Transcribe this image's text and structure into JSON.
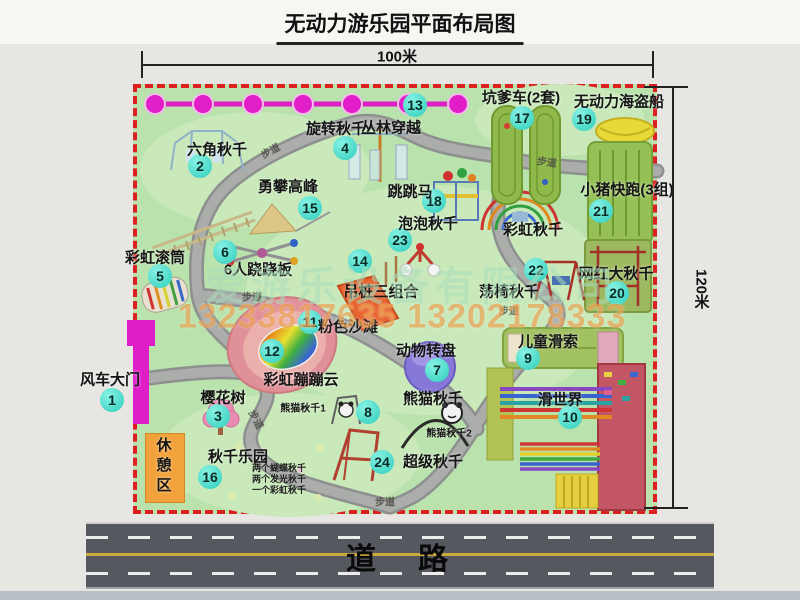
{
  "title": "无动力游乐园平面布局图",
  "dimensions": {
    "top": "100米",
    "right": "120米"
  },
  "road_label": "道　路",
  "watermark": {
    "company": "爱游乐设备有限公司",
    "phone": "13233817635 13202178333"
  },
  "colors": {
    "park_green": "#b9e2ac",
    "border_red": "#dc1f1f",
    "badge_teal": "#2fcdbb",
    "road_gray": "#56585f",
    "zipline_magenta": "#e01ec8",
    "rest_orange": "#f2a23a",
    "center_line_yellow": "#c9a93c"
  },
  "park": {
    "items": [
      {
        "id": "windmill-gate",
        "num": "1",
        "label": "风车大门",
        "bx": 112,
        "by": 400,
        "lx": 110,
        "ly": 379
      },
      {
        "id": "hex-swing",
        "num": "2",
        "label": "六角秋千",
        "bx": 200,
        "by": 166,
        "lx": 217,
        "ly": 149
      },
      {
        "id": "sakura-tree",
        "num": "3",
        "label": "樱花树",
        "bx": 218,
        "by": 416,
        "lx": 223,
        "ly": 397
      },
      {
        "id": "rotating-swing",
        "num": "4",
        "label": "旋转秋千",
        "bx": 345,
        "by": 148,
        "lx": 336,
        "ly": 128
      },
      {
        "id": "rainbow-roller",
        "num": "5",
        "label": "彩虹滚筒",
        "bx": 160,
        "by": 276,
        "lx": 155,
        "ly": 257
      },
      {
        "id": "seesaw-6p",
        "num": "6",
        "label": "6人跷跷板",
        "bx": 225,
        "by": 252,
        "lx": 258,
        "ly": 269
      },
      {
        "id": "animal-turntable",
        "num": "7",
        "label": "动物转盘",
        "bx": 437,
        "by": 370,
        "lx": 426,
        "ly": 350
      },
      {
        "id": "panda-swing",
        "num": "8",
        "label": "熊猫秋千",
        "bx": 368,
        "by": 412,
        "lx": 433,
        "ly": 398
      },
      {
        "id": "kids-zipline",
        "num": "9",
        "label": "儿童滑索",
        "bx": 528,
        "by": 358,
        "lx": 548,
        "ly": 341
      },
      {
        "id": "slide-world",
        "num": "10",
        "label": "滑世界",
        "bx": 570,
        "by": 417,
        "lx": 560,
        "ly": 399
      },
      {
        "id": "pink-beach",
        "num": "11",
        "label": "粉色沙滩",
        "bx": 310,
        "by": 322,
        "lx": 348,
        "ly": 326
      },
      {
        "id": "rainbow-cloud",
        "num": "12",
        "label": "彩虹蹦蹦云",
        "bx": 272,
        "by": 351,
        "lx": 301,
        "ly": 379
      },
      {
        "id": "jungle-crossing",
        "num": "13",
        "label": "丛林穿越",
        "bx": 415,
        "by": 105,
        "lx": 391,
        "ly": 127
      },
      {
        "id": "pile-combo",
        "num": "14",
        "label": "吊桩三组合",
        "bx": 360,
        "by": 261,
        "lx": 381,
        "ly": 291
      },
      {
        "id": "brave-peak",
        "num": "15",
        "label": "勇攀高峰",
        "bx": 310,
        "by": 208,
        "lx": 288,
        "ly": 186
      },
      {
        "id": "swing-park",
        "num": "16",
        "label": "秋千乐园",
        "bx": 210,
        "by": 477,
        "lx": 238,
        "ly": 456,
        "sub": [
          "两个蝴蝶秋千",
          "两个发光秋千",
          "一个彩虹秋千"
        ],
        "sx": 252,
        "sy": 463
      },
      {
        "id": "pit-car",
        "num": "17",
        "label": "坑爹车(2套)",
        "bx": 522,
        "by": 118,
        "lx": 521,
        "ly": 97
      },
      {
        "id": "jump-horse",
        "num": "18",
        "label": "跳跳马",
        "bx": 434,
        "by": 201,
        "lx": 410,
        "ly": 191
      },
      {
        "id": "pirate-ship",
        "num": "19",
        "label": "无动力海盗船",
        "bx": 584,
        "by": 119,
        "lx": 619,
        "ly": 101
      },
      {
        "id": "big-net-swing",
        "num": "20",
        "label": "网红大秋千",
        "bx": 617,
        "by": 293,
        "lx": 616,
        "ly": 273
      },
      {
        "id": "pig-run",
        "num": "21",
        "label": "小猪快跑(3组)",
        "bx": 601,
        "by": 211,
        "lx": 627,
        "ly": 189
      },
      {
        "id": "chair-swing",
        "num": "22",
        "label": "荡椅秋千",
        "bx": 536,
        "by": 270,
        "lx": 509,
        "ly": 291
      },
      {
        "id": "bubble-swing",
        "num": "23",
        "label": "泡泡秋千",
        "bx": 400,
        "by": 240,
        "lx": 428,
        "ly": 223
      },
      {
        "id": "super-swing",
        "num": "24",
        "label": "超级秋千",
        "bx": 382,
        "by": 462,
        "lx": 433,
        "ly": 461
      },
      {
        "id": "rainbow-swing",
        "label": "彩虹秋千",
        "lx": 533,
        "ly": 229
      },
      {
        "id": "panda-swing-1",
        "label": "熊猫秋千1",
        "lx": 303,
        "ly": 407,
        "ls": 10
      },
      {
        "id": "panda-swing-2",
        "label": "熊猫秋千2",
        "lx": 449,
        "ly": 432,
        "ls": 10
      },
      {
        "id": "rest-area",
        "label": "休憩区",
        "lx": 163,
        "ly": 467,
        "vertical": true,
        "ls": 15
      }
    ],
    "path_labels": [
      {
        "t": "步道",
        "x": 270,
        "y": 150,
        "r": -28
      },
      {
        "t": "步道",
        "x": 547,
        "y": 161,
        "r": 8
      },
      {
        "t": "步道",
        "x": 252,
        "y": 296,
        "r": 0
      },
      {
        "t": "步道",
        "x": 509,
        "y": 310,
        "r": 0
      },
      {
        "t": "步道",
        "x": 257,
        "y": 419,
        "r": 62
      },
      {
        "t": "步道",
        "x": 385,
        "y": 501,
        "r": 0
      }
    ]
  }
}
